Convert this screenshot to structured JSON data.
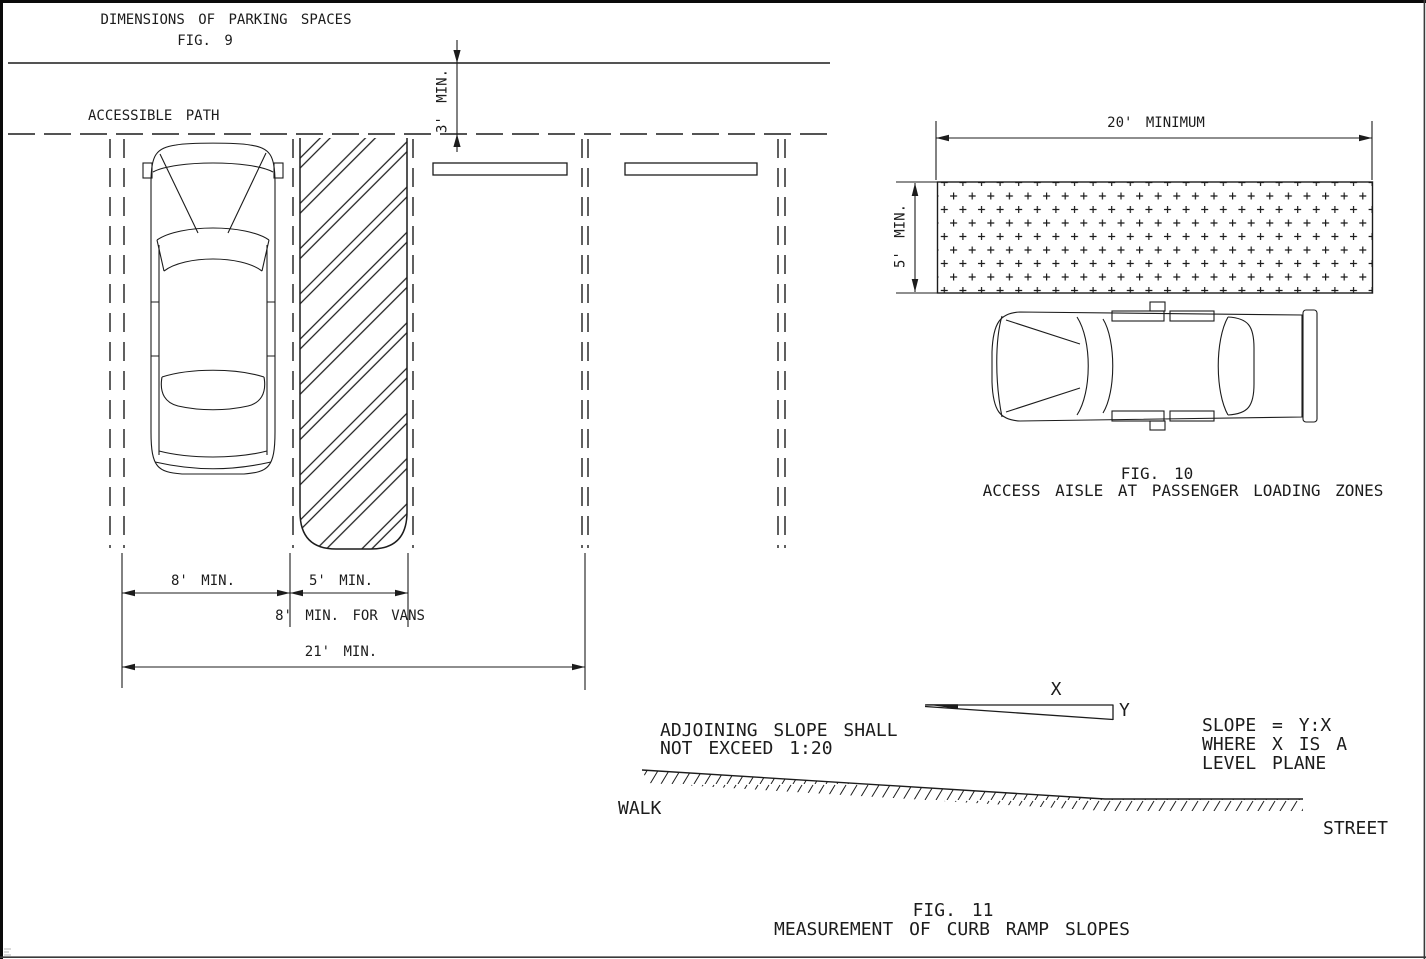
{
  "colors": {
    "line": "#1c1c1c",
    "background": "#ffffff"
  },
  "fig9": {
    "title": "DIMENSIONS OF PARKING SPACES",
    "fig_label": "FIG. 9",
    "accessible_path": "ACCESSIBLE PATH",
    "dims": {
      "path_width": "3' MIN.",
      "car_space": "8' MIN.",
      "access_aisle": "5' MIN.",
      "van_aisle": "8' MIN. FOR VANS",
      "total": "21' MIN."
    }
  },
  "fig10": {
    "dims": {
      "length": "20' MINIMUM",
      "width": "5' MIN."
    },
    "fig_label": "FIG. 10",
    "caption": "ACCESS AISLE AT PASSENGER LOADING ZONES"
  },
  "fig11": {
    "note": {
      "line1": "ADJOINING SLOPE SHALL",
      "line2": "NOT EXCEED 1:20"
    },
    "axis": {
      "x": "X",
      "y": "Y"
    },
    "formula": {
      "line1": "SLOPE = Y:X",
      "line2": "WHERE X IS A",
      "line3": "LEVEL PLANE"
    },
    "walk": "WALK",
    "street": "STREET",
    "fig_label": "FIG. 11",
    "caption": "MEASUREMENT OF CURB RAMP SLOPES"
  }
}
